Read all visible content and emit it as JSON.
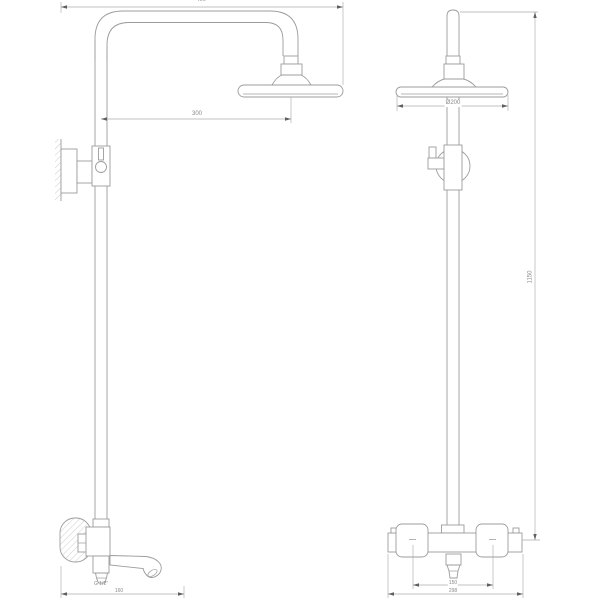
{
  "front_view": {
    "dim_overall_width": "400",
    "dim_head_offset": "300",
    "dim_spout_reach": "160",
    "label_spout_thread": "G 1/2\""
  },
  "side_view": {
    "dim_head_diameter": "Ø200",
    "dim_overall_height": "1150",
    "dim_inlet_spacing": "150",
    "dim_overall_width": "298"
  },
  "colors": {
    "background": "#ffffff",
    "object_line": "#9c9c9c",
    "dimension_line": "#ababab",
    "arrow": "#5f5f5f",
    "text": "#8a8a8a"
  }
}
